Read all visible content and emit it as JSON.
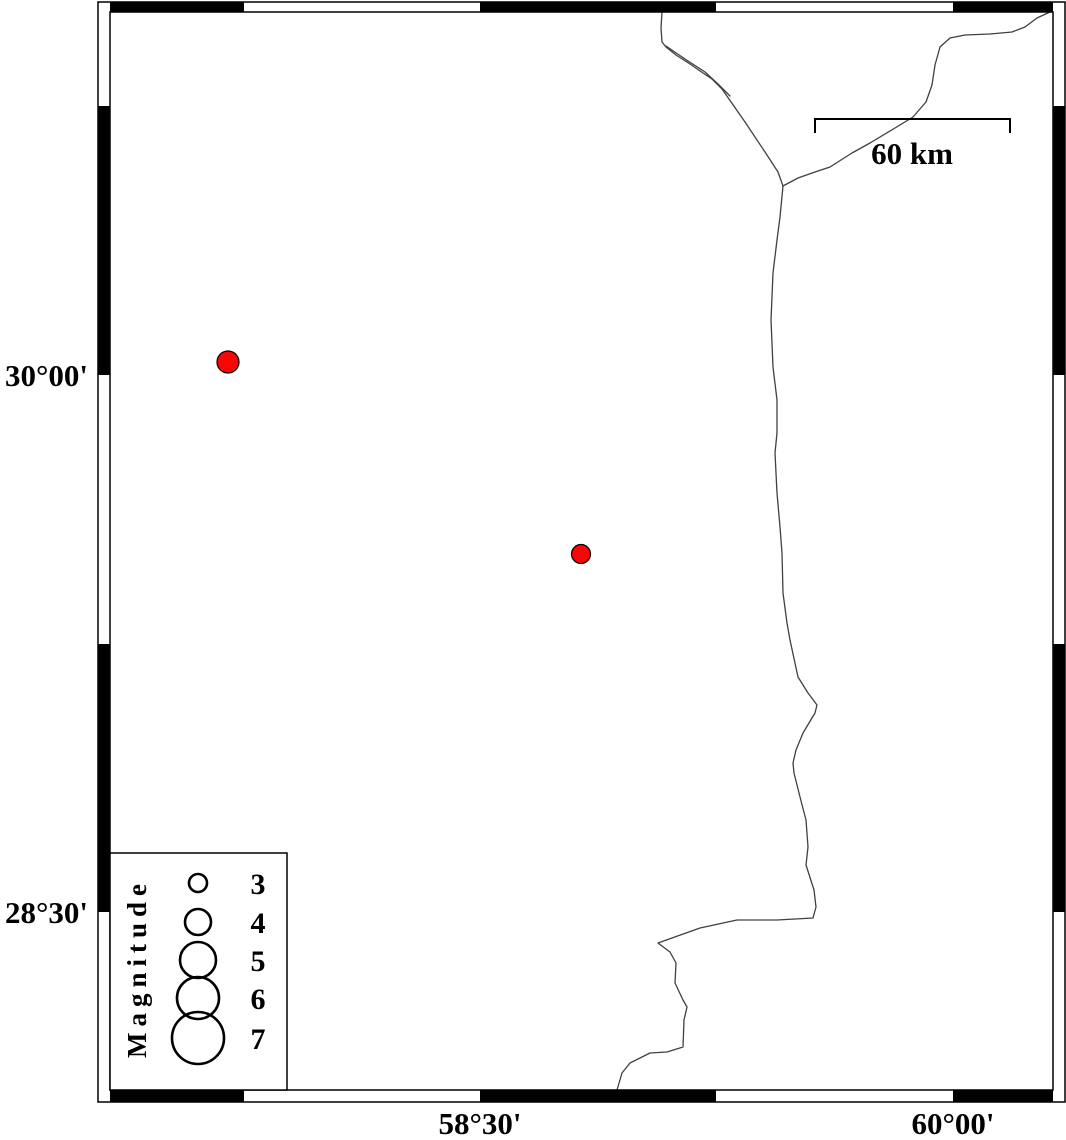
{
  "axes": {
    "left_labels": [
      {
        "text": "30°00'",
        "y": 375
      },
      {
        "text": "28°30'",
        "y": 912
      }
    ],
    "bottom_labels": [
      {
        "text": "58°30'",
        "x": 480
      },
      {
        "text": "60°00'",
        "x": 953
      }
    ]
  },
  "scale_bar": {
    "label": "60 km",
    "x1": 815,
    "x2": 1010,
    "y": 119,
    "tick_drop": 14,
    "label_x": 912,
    "label_y": 164
  },
  "legend": {
    "title": "Magnitude",
    "box": {
      "x": 110,
      "y": 853,
      "w": 177,
      "h": 237
    },
    "circle_cx": 198,
    "label_x": 258,
    "entries": [
      {
        "label": "3",
        "cy": 883,
        "r": 9
      },
      {
        "label": "4",
        "cy": 922,
        "r": 13
      },
      {
        "label": "5",
        "cy": 960,
        "r": 18
      },
      {
        "label": "6",
        "cy": 998,
        "r": 21
      },
      {
        "label": "7",
        "cy": 1038,
        "r": 26
      }
    ]
  },
  "epicenters": [
    {
      "x": 228,
      "y": 362,
      "r": 11
    },
    {
      "x": 581,
      "y": 554,
      "r": 9.5
    }
  ],
  "frame": {
    "outer": {
      "x": 98,
      "y": 2,
      "w": 967,
      "h": 1100
    },
    "inner": {
      "x": 110,
      "y": 12,
      "w": 943,
      "h": 1078
    },
    "top_band": {
      "y": 2,
      "h": 10
    },
    "bottom_band": {
      "y": 1090,
      "h": 12
    },
    "left_band": {
      "x": 98,
      "w": 12
    },
    "right_band": {
      "x": 1053,
      "w": 12
    },
    "horizontal_black_segments": [
      [
        110,
        244
      ],
      [
        480,
        716
      ],
      [
        953,
        1053
      ]
    ],
    "vertical_black_segments": [
      [
        106,
        375
      ],
      [
        644,
        912
      ]
    ]
  },
  "map_lines": {
    "main": [
      [
        662,
        12
      ],
      [
        661,
        28
      ],
      [
        662,
        42
      ],
      [
        666,
        47
      ],
      [
        676,
        55
      ],
      [
        690,
        64
      ],
      [
        703,
        73
      ],
      [
        712,
        79
      ],
      [
        722,
        89
      ],
      [
        745,
        122
      ],
      [
        765,
        152
      ],
      [
        778,
        172
      ],
      [
        783,
        186
      ],
      [
        780,
        217
      ],
      [
        777,
        240
      ],
      [
        773,
        273
      ],
      [
        771,
        320
      ],
      [
        773,
        367
      ],
      [
        777,
        400
      ],
      [
        777,
        433
      ],
      [
        775,
        453
      ],
      [
        777,
        493
      ],
      [
        780,
        527
      ],
      [
        782,
        553
      ],
      [
        783,
        593
      ],
      [
        787,
        623
      ],
      [
        790,
        640
      ],
      [
        798,
        677
      ],
      [
        808,
        693
      ],
      [
        817,
        705
      ],
      [
        815,
        713
      ],
      [
        803,
        733
      ],
      [
        796,
        750
      ],
      [
        793,
        763
      ],
      [
        794,
        773
      ],
      [
        800,
        797
      ],
      [
        806,
        820
      ],
      [
        808,
        847
      ],
      [
        806,
        865
      ],
      [
        814,
        890
      ],
      [
        816,
        907
      ],
      [
        813,
        918
      ],
      [
        777,
        920
      ],
      [
        737,
        920
      ],
      [
        700,
        928
      ],
      [
        658,
        943
      ],
      [
        670,
        952
      ],
      [
        676,
        963
      ],
      [
        675,
        983
      ],
      [
        683,
        1000
      ],
      [
        687,
        1007
      ],
      [
        684,
        1020
      ],
      [
        683,
        1047
      ],
      [
        667,
        1052
      ],
      [
        650,
        1053
      ],
      [
        630,
        1063
      ],
      [
        622,
        1073
      ],
      [
        617,
        1090
      ]
    ],
    "parallel": [
      [
        666,
        46
      ],
      [
        685,
        59
      ],
      [
        705,
        72
      ],
      [
        718,
        84
      ],
      [
        730,
        96
      ]
    ],
    "branch": [
      [
        783,
        186
      ],
      [
        798,
        178
      ],
      [
        815,
        172
      ],
      [
        830,
        167
      ],
      [
        852,
        153
      ],
      [
        870,
        143
      ],
      [
        895,
        128
      ],
      [
        913,
        117
      ],
      [
        926,
        102
      ],
      [
        932,
        85
      ],
      [
        935,
        65
      ],
      [
        940,
        47
      ],
      [
        950,
        38
      ],
      [
        965,
        35
      ],
      [
        990,
        34
      ],
      [
        1012,
        32
      ],
      [
        1025,
        27
      ],
      [
        1037,
        18
      ],
      [
        1050,
        12
      ]
    ]
  },
  "colors": {
    "epicenter_fill": "#f90505",
    "epicenter_stroke": "#000000",
    "line": "#404040",
    "frame": "#000000",
    "background": "#ffffff"
  }
}
